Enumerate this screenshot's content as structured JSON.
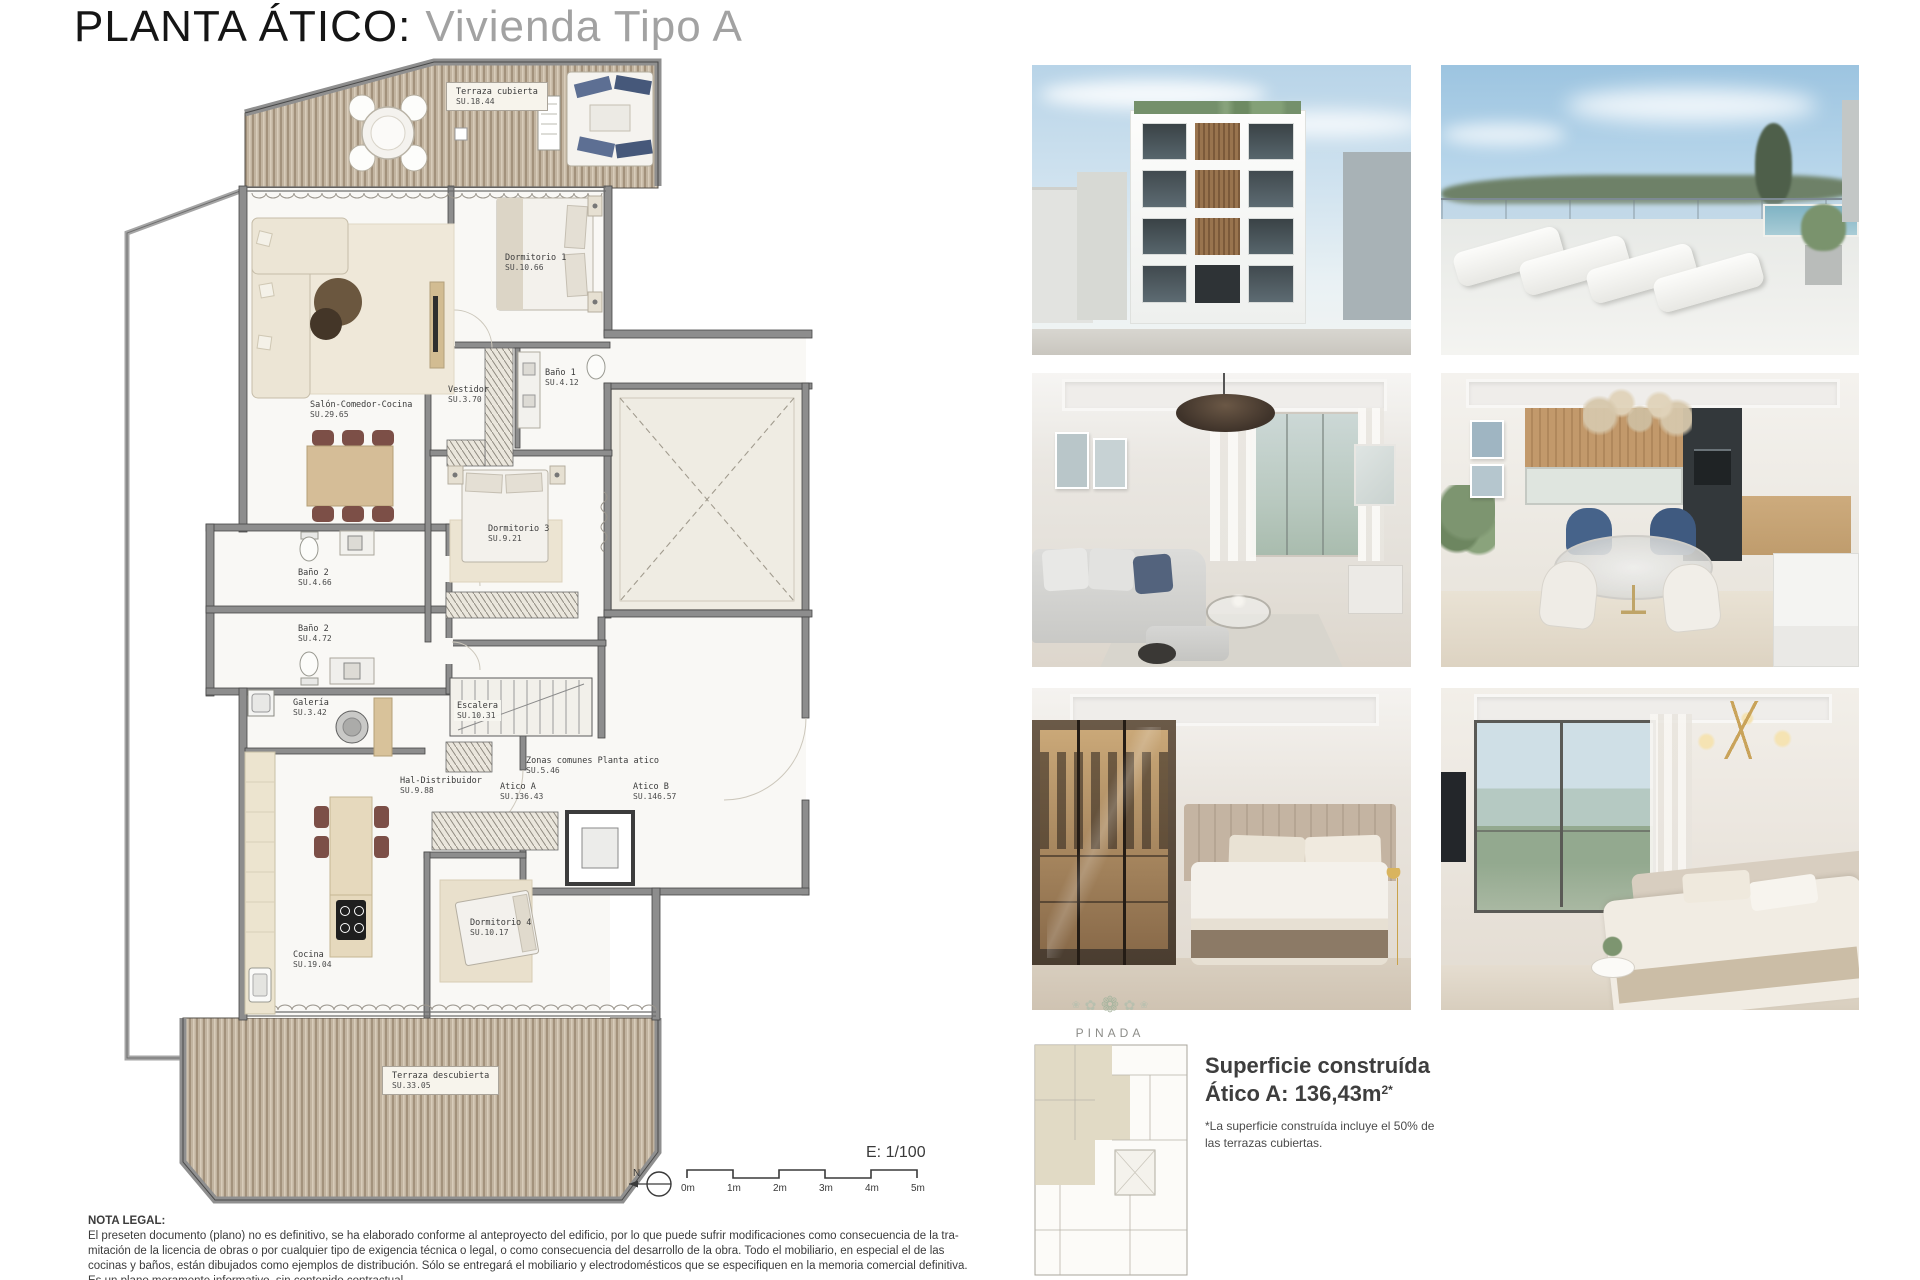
{
  "title": {
    "main": "PLANTA ÁTICO:",
    "sub": "Vivienda Tipo A"
  },
  "floor_plan": {
    "rooms": [
      {
        "name": "Terraza cubierta",
        "area": "SU.18.44"
      },
      {
        "name": "Dormitorio 1",
        "area": "SU.10.66"
      },
      {
        "name": "Vestidor",
        "area": "SU.3.70"
      },
      {
        "name": "Baño 1",
        "area": "SU.4.12"
      },
      {
        "name": "Salón-Comedor-Cocina",
        "area": "SU.29.65"
      },
      {
        "name": "Dormitorio 3",
        "area": "SU.9.21"
      },
      {
        "name": "Baño 2",
        "area": "SU.4.66"
      },
      {
        "name": "Baño 2",
        "area": "SU.4.72"
      },
      {
        "name": "Galería",
        "area": "SU.3.42"
      },
      {
        "name": "Escalera",
        "area": "SU.10.31"
      },
      {
        "name": "Hal-Distribuidor",
        "area": "SU.9.88"
      },
      {
        "name": "Zonas comunes Planta atico",
        "area": "SU.5.46"
      },
      {
        "name": "Atico A",
        "area": "SU.136.43"
      },
      {
        "name": "Atico B",
        "area": "SU.146.57"
      },
      {
        "name": "Dormitorio 4",
        "area": "SU.10.17"
      },
      {
        "name": "Cocina",
        "area": "SU.19.04"
      },
      {
        "name": "Terraza descubierta",
        "area": "SU.33.05"
      }
    ],
    "scale": {
      "label": "E: 1/100",
      "north": "N",
      "ticks": [
        "0m",
        "1m",
        "2m",
        "3m",
        "4m",
        "5m"
      ]
    }
  },
  "summary": {
    "brand": "PINADA",
    "heading_line1": "Superficie construída",
    "heading_line2": "Ático A: 136,43m",
    "heading_sup": "2*",
    "note_line1": "*La superficie construída incluye el 50% de",
    "note_line2": "las terrazas cubiertas."
  },
  "legal": {
    "heading": "NOTA LEGAL:",
    "lines": [
      "El preseten documento (plano) no es definitivo, se ha elaborado conforme al anteproyecto del edificio, por lo que puede sufrir modificaciones como consecuencia de la tra-",
      "mitación de la licencia de obras o por cualquier tipo de exigencia técnica o legal, o como consecuencia del desarrollo de la obra. Todo el mobiliario, en especial el de las",
      "cocinas y baños, están dibujados como ejemplos de distribución. Sólo se entregará el mobiliario y electrodomésticos que se especifiquen en la memoria comercial definitiva.",
      "Es un plano meramente informativo, sin contenido contractual."
    ]
  },
  "photos": {
    "names": [
      "building-exterior",
      "rooftop-terrace",
      "living-room",
      "dining-room",
      "bedroom-dressing",
      "bedroom-views"
    ]
  },
  "colors": {
    "deck_wood": "#c2b4a0",
    "wall_gray": "#8d8d8d",
    "title_muted": "#a2a2a2",
    "highlight_beige": "#dcd4bc"
  }
}
